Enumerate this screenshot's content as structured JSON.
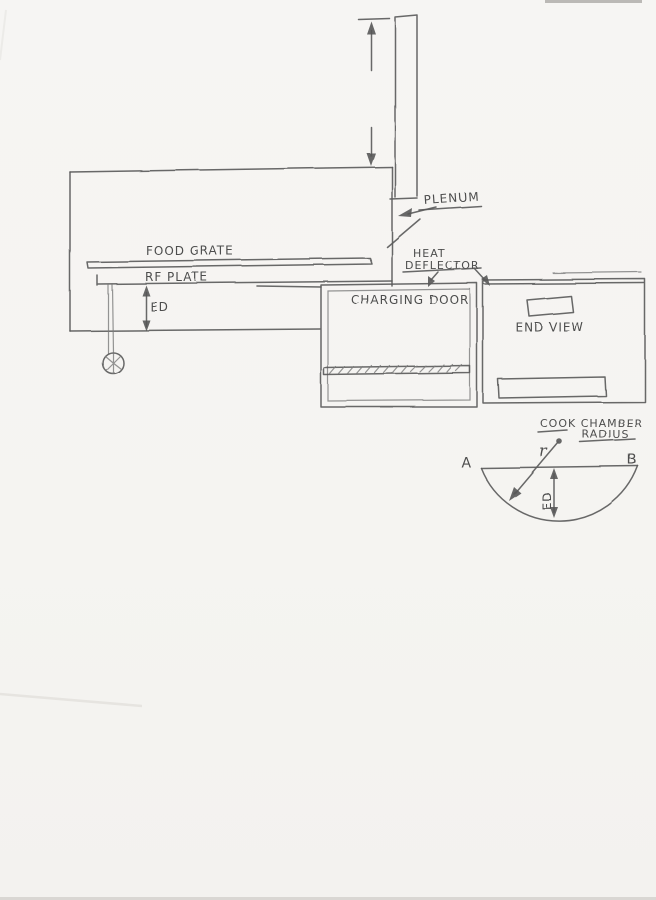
{
  "colors": {
    "paper": "#f5f4f2",
    "pencil": "#595959"
  },
  "side_view": {
    "plenum_label": "PLENUM",
    "heat_deflector_label_line1": "HEAT",
    "heat_deflector_label_line2": "DEFLECTOR",
    "food_grate_label": "FOOD GRATE",
    "rf_plate_label": "RF PLATE",
    "ed_label": "ED"
  },
  "charging_door_view": {
    "label": "CHARGING DOOR"
  },
  "end_view": {
    "label": "END VIEW"
  },
  "section_view": {
    "title_line1": "COOK CHAMBER",
    "title_line2": "RADIUS",
    "radius_label": "r",
    "point_a": "A",
    "point_b": "B",
    "ed_label": "ED"
  }
}
